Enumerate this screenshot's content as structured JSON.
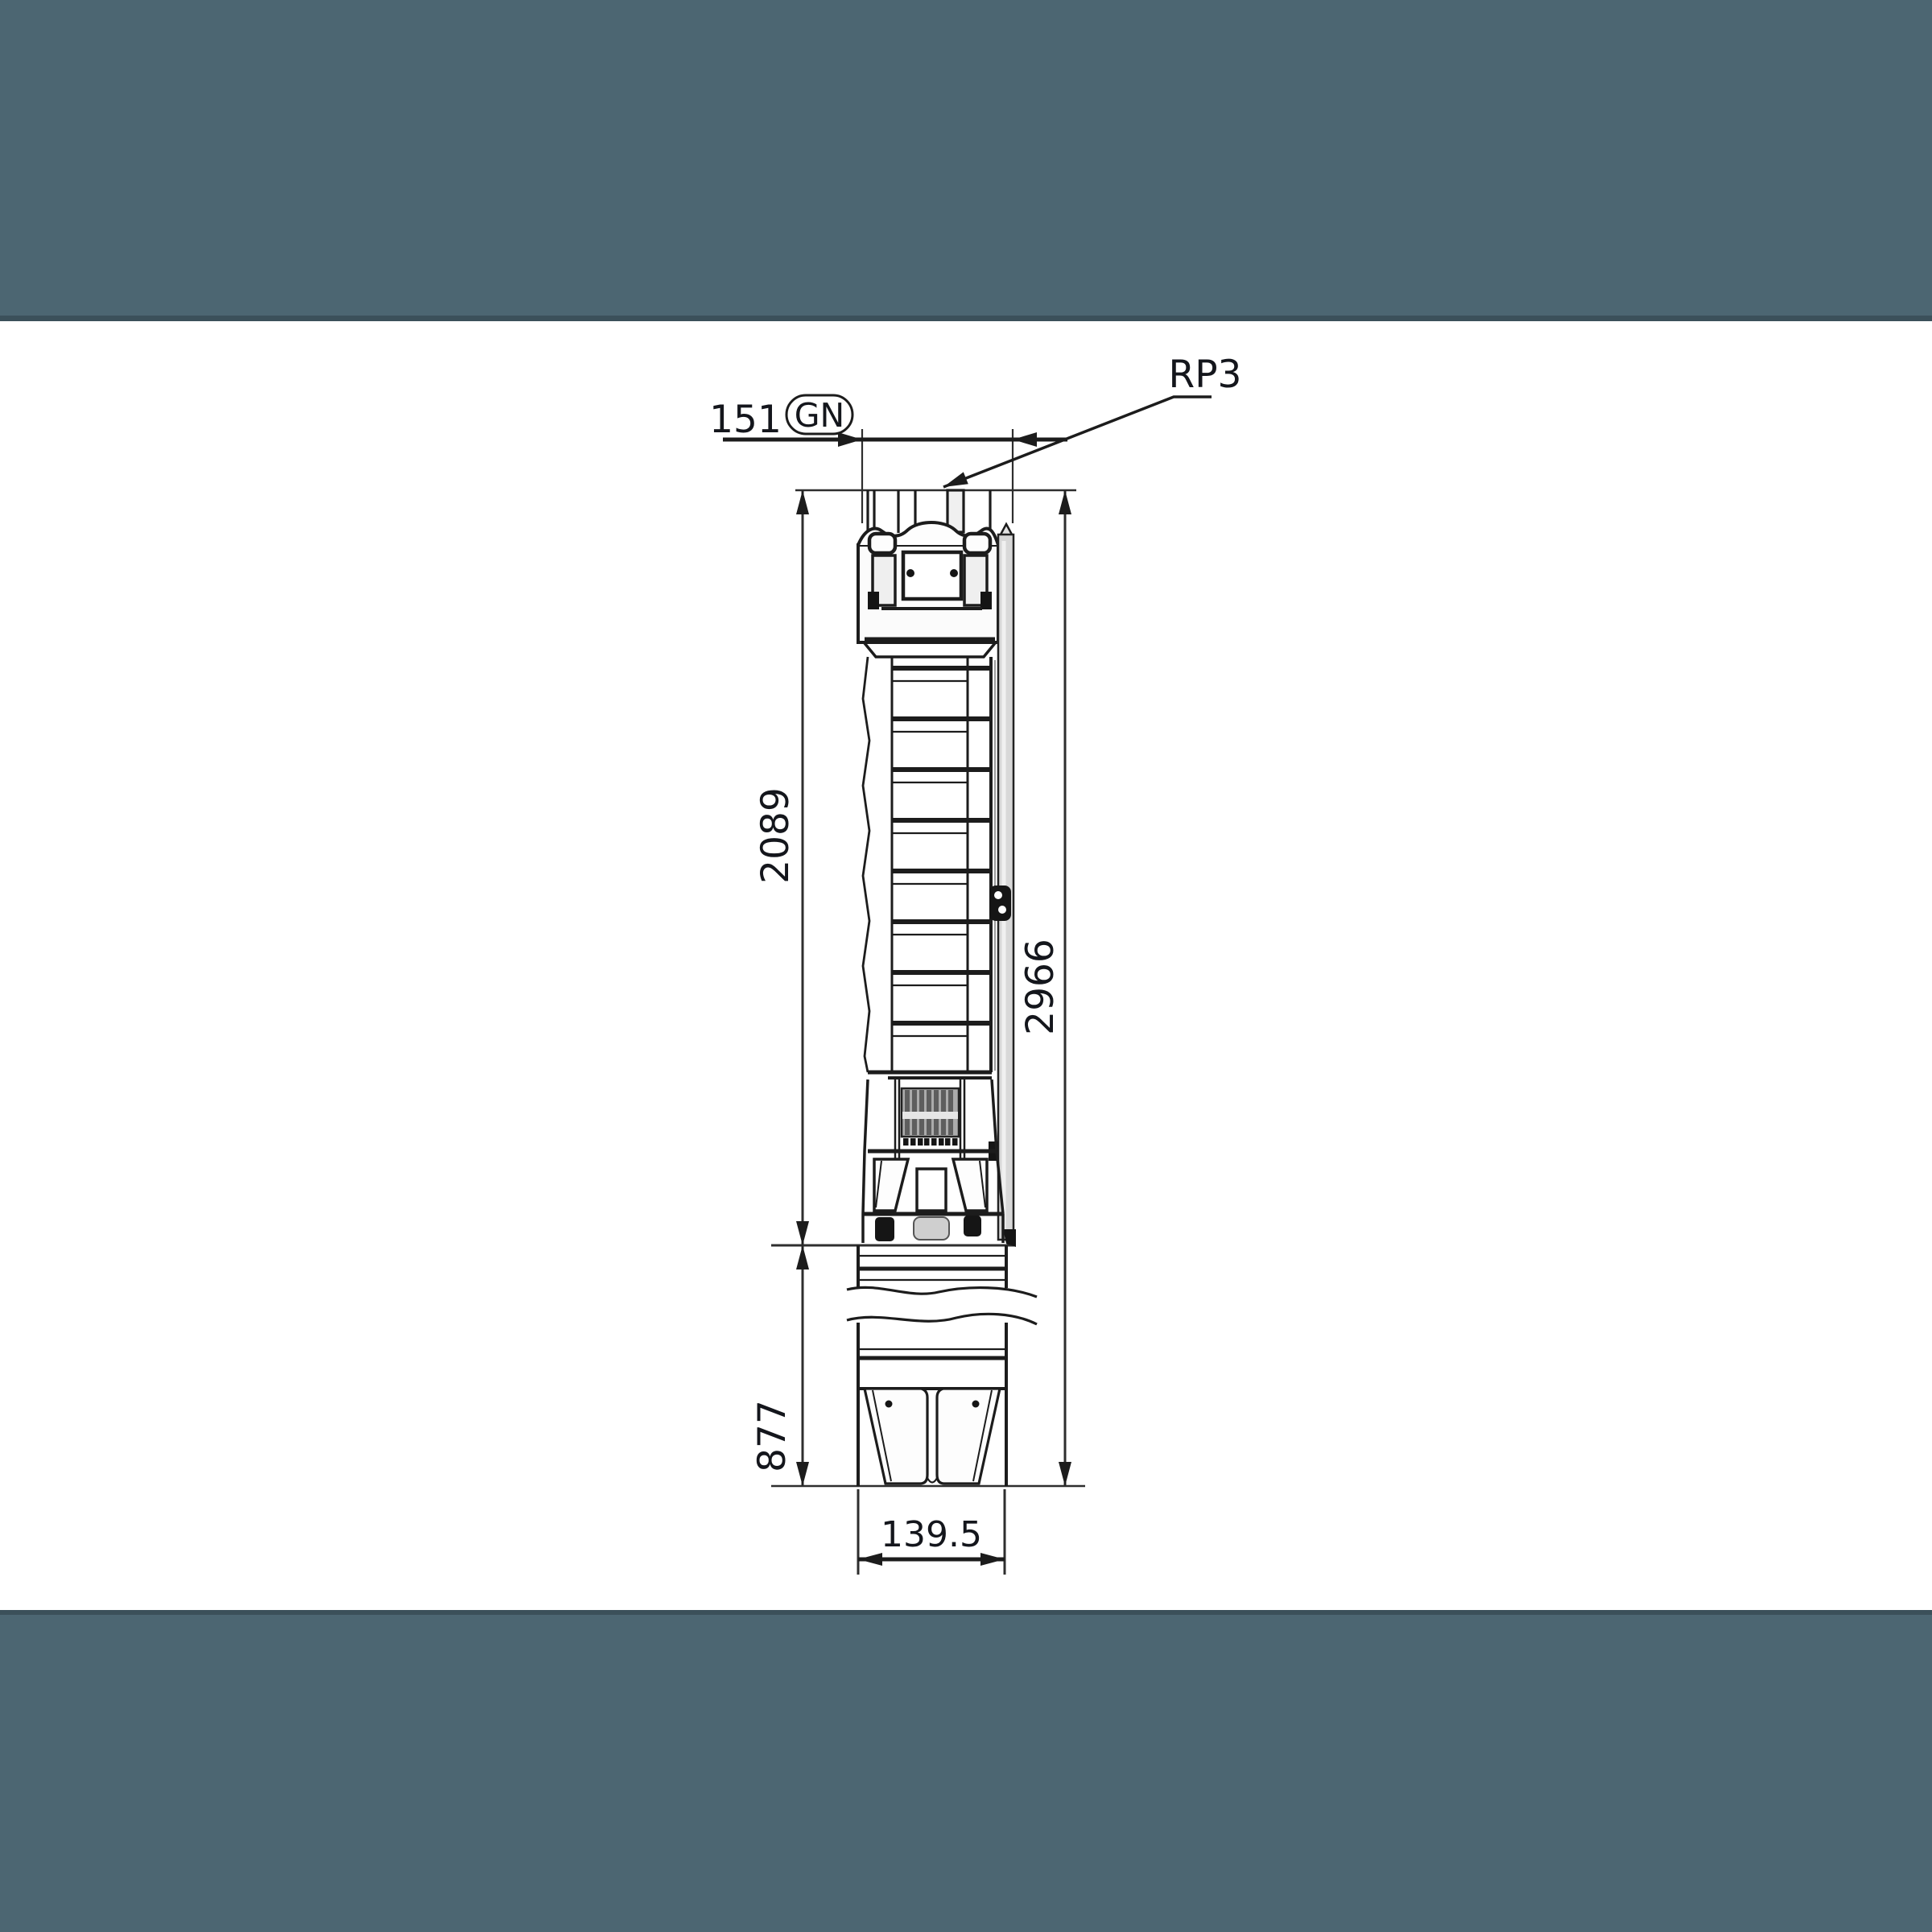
{
  "letterbox": {
    "color": "#4c6672",
    "edge_color": "#3b505a"
  },
  "canvas": {
    "background": "#ffffff"
  },
  "drawing": {
    "labels": {
      "dim_top_width": "151",
      "port_code": "GN",
      "connection_thread": "RP3",
      "dim_pump_length": "2089",
      "dim_overall_length": "2966",
      "dim_motor_length": "877",
      "dim_diameter": "139.5"
    },
    "colors": {
      "object_line": "#1c1c1c",
      "dimension_line": "#2e2e2e",
      "text": "#14161c",
      "cable_guard_fill": "#d8d8d8",
      "strainer_fill": "#ababab"
    }
  }
}
